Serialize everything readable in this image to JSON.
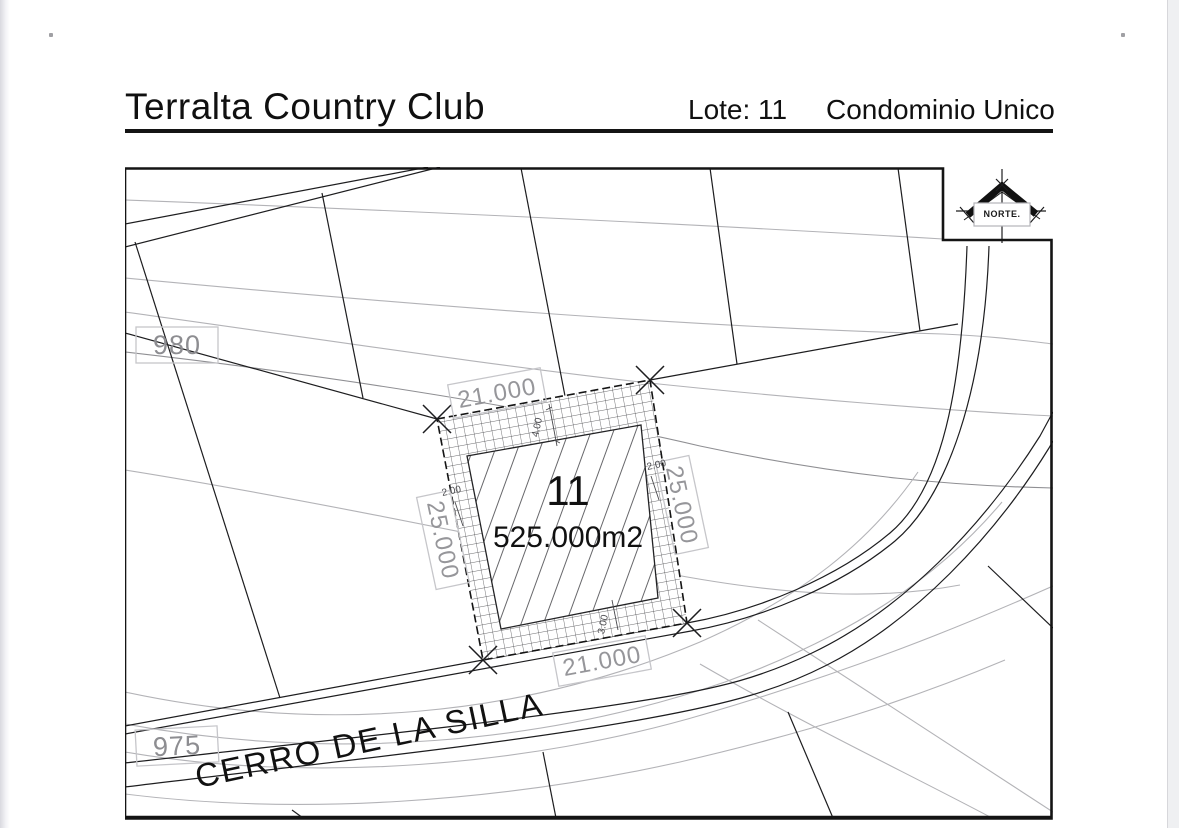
{
  "header": {
    "title": "Terralta Country Club",
    "lot_ref": "Lote: 11",
    "condo_ref": "Condominio Unico"
  },
  "plan": {
    "north_label": "NORTE.",
    "street_name": "CERRO DE LA SILLA",
    "contours": {
      "label_980": "980",
      "label_975": "975"
    },
    "lot": {
      "number": "11",
      "area": "525.000m2",
      "dim_top": "21.000",
      "dim_bottom": "21.000",
      "dim_left": "25.000",
      "dim_right": "25.000",
      "setback_top": "4.00",
      "setback_right": "2.00",
      "setback_left": "2.00",
      "setback_bottom": "3.00"
    }
  },
  "colors": {
    "ink": "#1a1a1a",
    "dim_gray": "#96969a",
    "contour_gray": "#b3b3b7",
    "box_gray": "#c6c6ca"
  }
}
